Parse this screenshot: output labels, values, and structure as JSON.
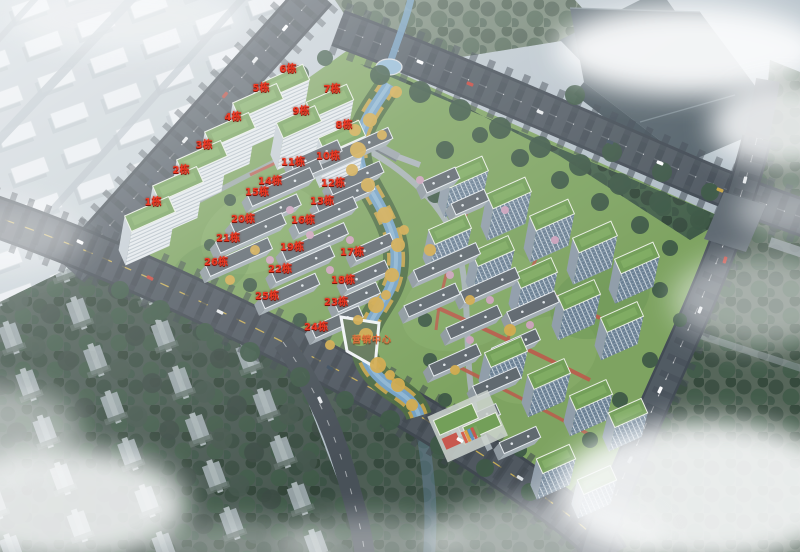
{
  "canvas": {
    "width": 800,
    "height": 552
  },
  "overlay_labels": [
    {
      "text": "1栋",
      "x": 153,
      "y": 203,
      "kind": "building"
    },
    {
      "text": "2栋",
      "x": 181,
      "y": 171,
      "kind": "building"
    },
    {
      "text": "3栋",
      "x": 204,
      "y": 146,
      "kind": "building"
    },
    {
      "text": "4栋",
      "x": 233,
      "y": 118,
      "kind": "building"
    },
    {
      "text": "5栋",
      "x": 261,
      "y": 89,
      "kind": "building"
    },
    {
      "text": "6栋",
      "x": 288,
      "y": 70,
      "kind": "building"
    },
    {
      "text": "7栋",
      "x": 332,
      "y": 90,
      "kind": "building"
    },
    {
      "text": "8栋",
      "x": 344,
      "y": 126,
      "kind": "building"
    },
    {
      "text": "9栋",
      "x": 301,
      "y": 112,
      "kind": "building"
    },
    {
      "text": "10栋",
      "x": 328,
      "y": 157,
      "kind": "building"
    },
    {
      "text": "11栋",
      "x": 293,
      "y": 163,
      "kind": "building"
    },
    {
      "text": "12栋",
      "x": 333,
      "y": 184,
      "kind": "building"
    },
    {
      "text": "13栋",
      "x": 322,
      "y": 202,
      "kind": "building"
    },
    {
      "text": "14栋",
      "x": 270,
      "y": 182,
      "kind": "building"
    },
    {
      "text": "15栋",
      "x": 257,
      "y": 193,
      "kind": "building"
    },
    {
      "text": "16栋",
      "x": 303,
      "y": 221,
      "kind": "building"
    },
    {
      "text": "17栋",
      "x": 352,
      "y": 253,
      "kind": "building"
    },
    {
      "text": "18栋",
      "x": 343,
      "y": 281,
      "kind": "building"
    },
    {
      "text": "19栋",
      "x": 292,
      "y": 248,
      "kind": "building"
    },
    {
      "text": "20栋",
      "x": 243,
      "y": 220,
      "kind": "building"
    },
    {
      "text": "21栋",
      "x": 228,
      "y": 239,
      "kind": "building"
    },
    {
      "text": "22栋",
      "x": 280,
      "y": 270,
      "kind": "building"
    },
    {
      "text": "23栋",
      "x": 336,
      "y": 303,
      "kind": "building"
    },
    {
      "text": "24栋",
      "x": 316,
      "y": 328,
      "kind": "building"
    },
    {
      "text": "25栋",
      "x": 267,
      "y": 297,
      "kind": "building"
    },
    {
      "text": "26栋",
      "x": 216,
      "y": 263,
      "kind": "building"
    },
    {
      "text": "营销中心",
      "x": 372,
      "y": 341,
      "kind": "amenity"
    }
  ],
  "colors": {
    "building_label": "#ee3a24",
    "building_label_outline": "#7d130a",
    "amenity_label": "#e4703e",
    "river_water": "#6f9ec2",
    "green_roof": "#6d9b4f",
    "site_lawn": "#79a058",
    "asphalt": "#4b545c",
    "red_path": "#b85542"
  }
}
